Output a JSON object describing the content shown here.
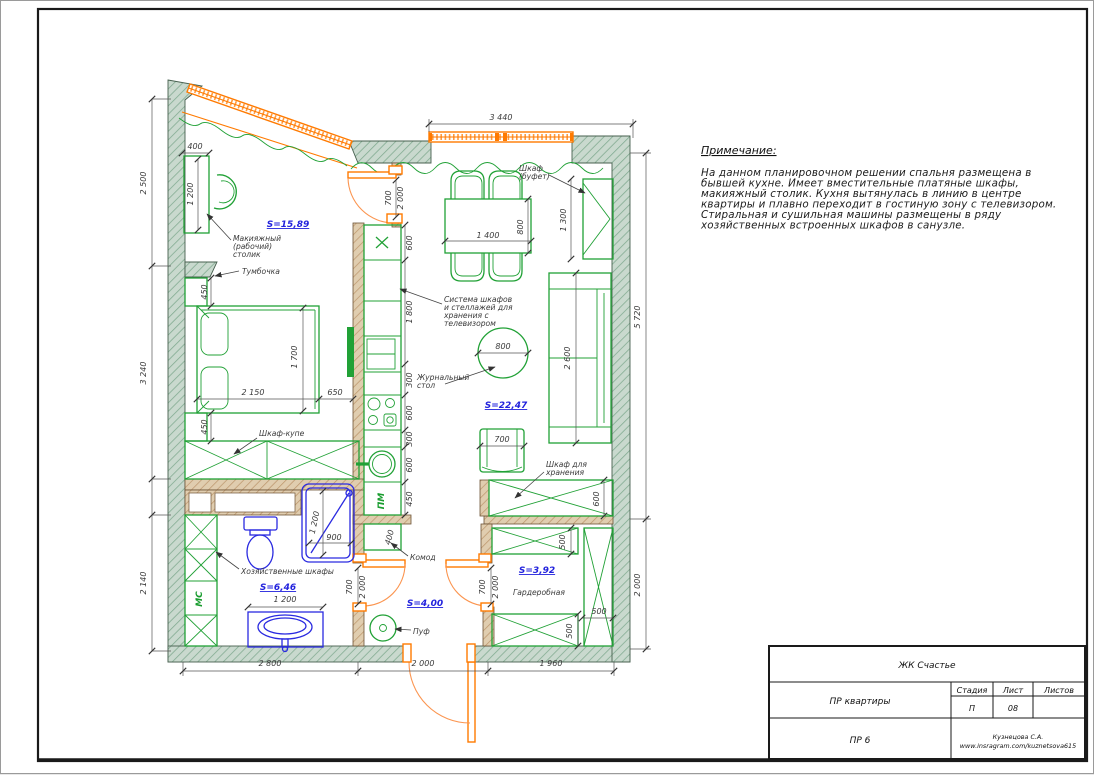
{
  "note": {
    "title": "Примечание:",
    "lines": [
      "На данном планировочном решении спальня размещена в",
      "бывшей кухне. Имеет вместительные платяные шкафы,",
      "макияжный столик. Кухня вытянулась в линию в центре",
      "квартиры и плавно переходит в гостиную зону с телевизором.",
      "Стиральная и сушильная машины размещены в ряду",
      "хозяйственных встроенных шкафов в санузле."
    ]
  },
  "title_block": {
    "project": "ЖК Счастье",
    "doc": "ПР квартиры",
    "stage_header": "Стадия",
    "sheet_header": "Лист",
    "sheets_header": "Листов",
    "stage": "П",
    "sheet": "08",
    "sheets": "",
    "code": "ПР 6",
    "author": "Кузнецова С.А.",
    "site": "www.insragram.com/kuznetsova615"
  },
  "areas": {
    "bedroom": "S=15,89",
    "living": "S=22,47",
    "bath": "S=6,46",
    "hall": "S=4,00",
    "wardrobe": "S=3,92"
  },
  "labels": {
    "makeup1": "Макияжный",
    "makeup2": "(рабочий)",
    "makeup3": "столик",
    "tumbochka": "Тумбочка",
    "buffet1": "Шкаф",
    "buffet2": "(буфет)",
    "sys1": "Система шкафов",
    "sys2": "и стеллажей для",
    "sys3": "хранения с",
    "sys4": "телевизором",
    "coffee1": "Журнальный",
    "coffee2": "стол",
    "kupe": "Шкаф-купе",
    "hoz": "Хозяйственные шкафы",
    "stor1": "Шкаф для",
    "stor2": "хранения",
    "komod": "Комод",
    "puf": "Пуф",
    "wardrobe_room": "Гардеробная",
    "mc": "МС",
    "pm": "ПМ"
  },
  "dims": {
    "top_window": "3 440",
    "makeup_width": "400",
    "left_top": "2 500",
    "left_mid": "3 240",
    "left_bot": "2 140",
    "makeup_depth": "1 200",
    "door_bed_w": "700",
    "door_bed_h": "2 000",
    "k600a": "600",
    "k1800": "1 800",
    "k300a": "300",
    "k600b": "600",
    "k300b": "300",
    "k600c": "600",
    "k450": "450",
    "komod_w": "400",
    "table_w": "1 400",
    "table_d": "800",
    "buffet_h": "1 300",
    "right_top": "5 720",
    "right_bot": "2 000",
    "bed_w": "2 150",
    "bed_gap": "650",
    "bed_l": "1 700",
    "nst_top": "450",
    "nst_bot": "450",
    "coffee_d": "800",
    "sofa_l": "2 600",
    "armchair_w": "700",
    "storage_d": "600",
    "shelf_top": "500",
    "shelf_bot": "500",
    "ward_d": "500",
    "door_ward_w": "700",
    "door_ward_h": "2 000",
    "door_bath_w": "700",
    "door_bath_h": "2 000",
    "shower_l": "1 200",
    "shower_w": "900",
    "basin_w": "1 200",
    "bottom_left": "2 800",
    "bottom_mid": "2 000",
    "bottom_right": "1 960"
  },
  "colors": {
    "wall_green": "#c9d9ce",
    "wall_brown": "#e0cdaf",
    "furniture": "#21a136",
    "plumbing": "#2a2ae0",
    "opening": "#ff7a00",
    "area_label": "#2222dd"
  }
}
